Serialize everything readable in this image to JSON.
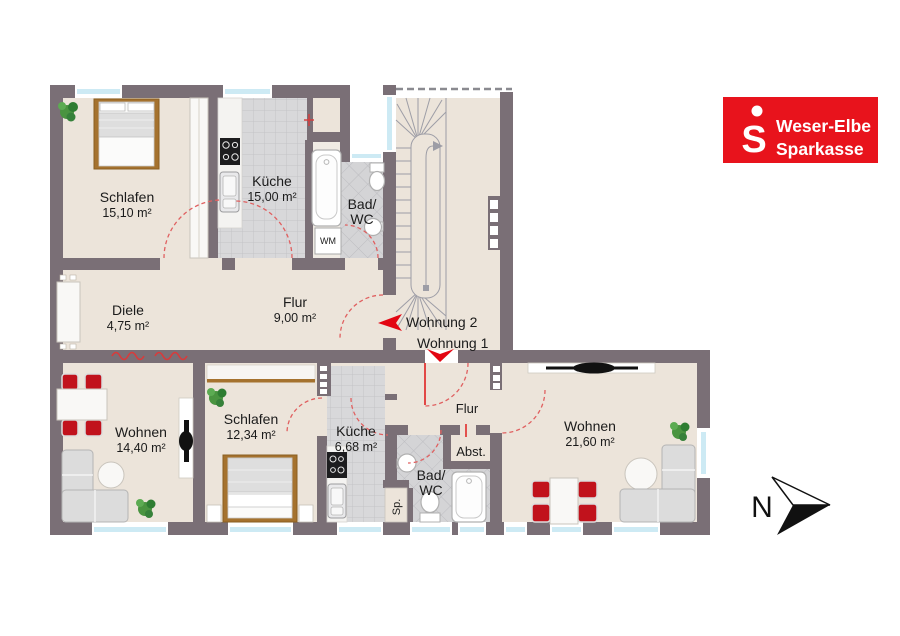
{
  "plan": {
    "units": {
      "wohnung2": "Wohnung 2",
      "wohnung1": "Wohnung 1"
    },
    "upper": {
      "schlafen": {
        "name": "Schlafen",
        "area": "15,10 m²"
      },
      "kueche": {
        "name": "Küche",
        "area": "15,00 m²"
      },
      "bad": {
        "line1": "Bad/",
        "line2": "WC"
      },
      "diele": {
        "name": "Diele",
        "area": "4,75 m²"
      },
      "flur": {
        "name": "Flur",
        "area": "9,00 m²"
      },
      "wm": "WM"
    },
    "lower": {
      "wohnen_links": {
        "name": "Wohnen",
        "area": "14,40 m²"
      },
      "schlafen": {
        "name": "Schlafen",
        "area": "12,34 m²"
      },
      "kueche": {
        "name": "Küche",
        "area": "6,68 m²"
      },
      "bad": {
        "line1": "Bad/",
        "line2": "WC"
      },
      "flur": {
        "name": "Flur"
      },
      "abstellraum": {
        "name": "Abst."
      },
      "speis": {
        "name": "Sp."
      },
      "wohnen_rechts": {
        "name": "Wohnen",
        "area": "21,60 m²"
      }
    }
  },
  "logo": {
    "symbol": "S",
    "brand_line1": "Weser-Elbe",
    "brand_line2": "Sparkasse"
  },
  "compass": {
    "north": "N"
  },
  "colors": {
    "wall": "#7a6f76",
    "floor": "#ece4da",
    "tile": "#d8d8da",
    "window_glass": "#cdeaf4",
    "accent_red": "#e30613",
    "chair_red": "#c1121c",
    "door_swing_red": "#e06060",
    "logo_red": "#e8131c",
    "wood_brown": "#a5722e"
  }
}
